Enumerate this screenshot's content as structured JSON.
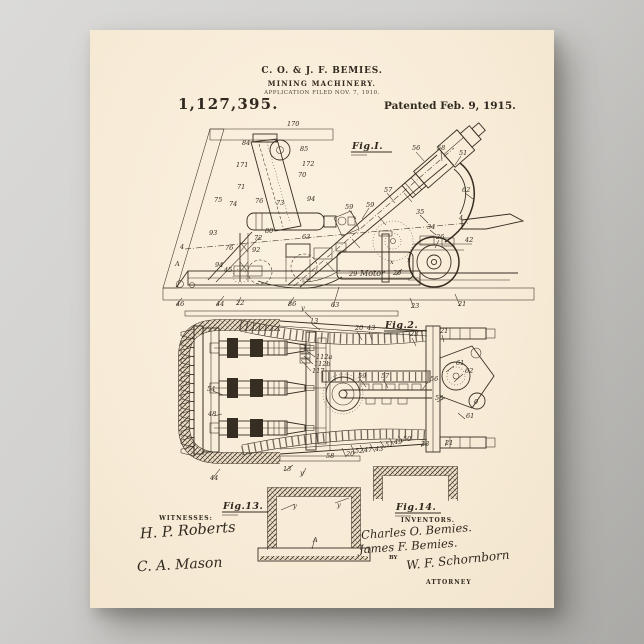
{
  "header": {
    "inventors_line": "C. O. & J. F. BEMIES.",
    "title_line": "MINING MACHINERY.",
    "application_line": "APPLICATION FILED NOV. 7, 1910.",
    "patent_number": "1,127,395.",
    "patented_line": "Patented Feb. 9, 1915."
  },
  "figures": {
    "fig1": {
      "label": "Fig.I.",
      "motor_label": "Motor",
      "ref_labels": [
        {
          "t": "170",
          "x": 197,
          "y": 96
        },
        {
          "t": "84",
          "x": 152,
          "y": 115
        },
        {
          "t": "85",
          "x": 210,
          "y": 121
        },
        {
          "t": "172",
          "x": 212,
          "y": 136
        },
        {
          "t": "70",
          "x": 208,
          "y": 147
        },
        {
          "t": "171",
          "x": 146,
          "y": 137
        },
        {
          "t": "71",
          "x": 147,
          "y": 159
        },
        {
          "t": "76",
          "x": 165,
          "y": 173
        },
        {
          "t": "73",
          "x": 186,
          "y": 175
        },
        {
          "t": "94",
          "x": 217,
          "y": 171
        },
        {
          "t": "75",
          "x": 124,
          "y": 172
        },
        {
          "t": "74",
          "x": 139,
          "y": 176
        },
        {
          "t": "93",
          "x": 119,
          "y": 205
        },
        {
          "t": "80",
          "x": 175,
          "y": 203
        },
        {
          "t": "72",
          "x": 164,
          "y": 210
        },
        {
          "t": "63",
          "x": 212,
          "y": 209
        },
        {
          "t": "4",
          "x": 90,
          "y": 219
        },
        {
          "t": "76",
          "x": 135,
          "y": 220
        },
        {
          "t": "92",
          "x": 162,
          "y": 222
        },
        {
          "t": "A",
          "x": 85,
          "y": 236
        },
        {
          "t": "94",
          "x": 125,
          "y": 237
        },
        {
          "t": "45",
          "x": 134,
          "y": 242
        },
        {
          "t": "59",
          "x": 255,
          "y": 179
        },
        {
          "t": "59",
          "x": 276,
          "y": 177
        },
        {
          "t": "57",
          "x": 294,
          "y": 162
        },
        {
          "t": "56",
          "x": 322,
          "y": 120
        },
        {
          "t": "58",
          "x": 347,
          "y": 120
        },
        {
          "t": "51",
          "x": 369,
          "y": 125
        },
        {
          "t": "62",
          "x": 372,
          "y": 162
        },
        {
          "t": "35",
          "x": 326,
          "y": 184
        },
        {
          "t": "34",
          "x": 337,
          "y": 199
        },
        {
          "t": "26",
          "x": 346,
          "y": 209
        },
        {
          "t": "4",
          "x": 369,
          "y": 190
        },
        {
          "t": "42",
          "x": 375,
          "y": 212
        },
        {
          "t": "x",
          "x": 300,
          "y": 234
        },
        {
          "t": "x",
          "x": 317,
          "y": 232
        },
        {
          "t": "20",
          "x": 303,
          "y": 245
        },
        {
          "t": "29",
          "x": 259,
          "y": 246
        },
        {
          "t": "46",
          "x": 86,
          "y": 276
        },
        {
          "t": "44",
          "x": 126,
          "y": 276
        },
        {
          "t": "22",
          "x": 146,
          "y": 275
        },
        {
          "t": "86",
          "x": 198,
          "y": 276
        },
        {
          "t": "63",
          "x": 241,
          "y": 277
        },
        {
          "t": "23",
          "x": 321,
          "y": 278
        },
        {
          "t": "21",
          "x": 368,
          "y": 276
        }
      ]
    },
    "fig2": {
      "label": "Fig.2.",
      "ref_labels": [
        {
          "t": "y",
          "x": 211,
          "y": 280
        },
        {
          "t": "13",
          "x": 220,
          "y": 293
        },
        {
          "t": "20",
          "x": 265,
          "y": 300
        },
        {
          "t": "43",
          "x": 277,
          "y": 300
        },
        {
          "t": "23",
          "x": 320,
          "y": 306
        },
        {
          "t": "21",
          "x": 350,
          "y": 303
        },
        {
          "t": "61",
          "x": 366,
          "y": 335
        },
        {
          "t": "62",
          "x": 375,
          "y": 343
        },
        {
          "t": "54",
          "x": 117,
          "y": 361
        },
        {
          "t": "48",
          "x": 118,
          "y": 386
        },
        {
          "t": "112a",
          "x": 226,
          "y": 329
        },
        {
          "t": "112b",
          "x": 224,
          "y": 336
        },
        {
          "t": "117",
          "x": 222,
          "y": 343
        },
        {
          "t": "59",
          "x": 268,
          "y": 348
        },
        {
          "t": "57",
          "x": 291,
          "y": 348
        },
        {
          "t": "56",
          "x": 340,
          "y": 351
        },
        {
          "t": "58",
          "x": 345,
          "y": 370
        },
        {
          "t": "61",
          "x": 376,
          "y": 388
        },
        {
          "t": "50",
          "x": 313,
          "y": 411
        },
        {
          "t": "49",
          "x": 304,
          "y": 414
        },
        {
          "t": "51",
          "x": 295,
          "y": 417
        },
        {
          "t": "43",
          "x": 285,
          "y": 421
        },
        {
          "t": "47",
          "x": 274,
          "y": 422
        },
        {
          "t": "52",
          "x": 265,
          "y": 423
        },
        {
          "t": "20",
          "x": 256,
          "y": 426
        },
        {
          "t": "58",
          "x": 236,
          "y": 428
        },
        {
          "t": "23",
          "x": 331,
          "y": 416
        },
        {
          "t": "21",
          "x": 355,
          "y": 415
        },
        {
          "t": "13",
          "x": 193,
          "y": 441
        },
        {
          "t": "y",
          "x": 210,
          "y": 445
        },
        {
          "t": "44",
          "x": 120,
          "y": 450
        },
        {
          "t": "0",
          "x": 384,
          "y": 374
        }
      ]
    },
    "fig13": {
      "label": "Fig.13.",
      "ref_labels": [
        {
          "t": "y",
          "x": 203,
          "y": 478
        },
        {
          "t": "y",
          "x": 247,
          "y": 477
        },
        {
          "t": "A",
          "x": 223,
          "y": 512
        }
      ]
    },
    "fig14": {
      "label": "Fig.14.",
      "ref_labels": []
    }
  },
  "footer": {
    "witnesses_heading": "WITNESSES:",
    "witnesses": [
      "H. P. Roberts",
      "C. A. Mason"
    ],
    "inventors_heading": "INVENTORS.",
    "inventors": [
      "Charles O. Bemies.",
      "James F. Bemies."
    ],
    "by_label": "BY",
    "attorney_signature": "W. F. Schornborn",
    "attorney_label": "ATTORNEY"
  },
  "colors": {
    "paper": "#f8ecd8",
    "ink": "#30291f",
    "backdrop": "#c4c3c0"
  }
}
